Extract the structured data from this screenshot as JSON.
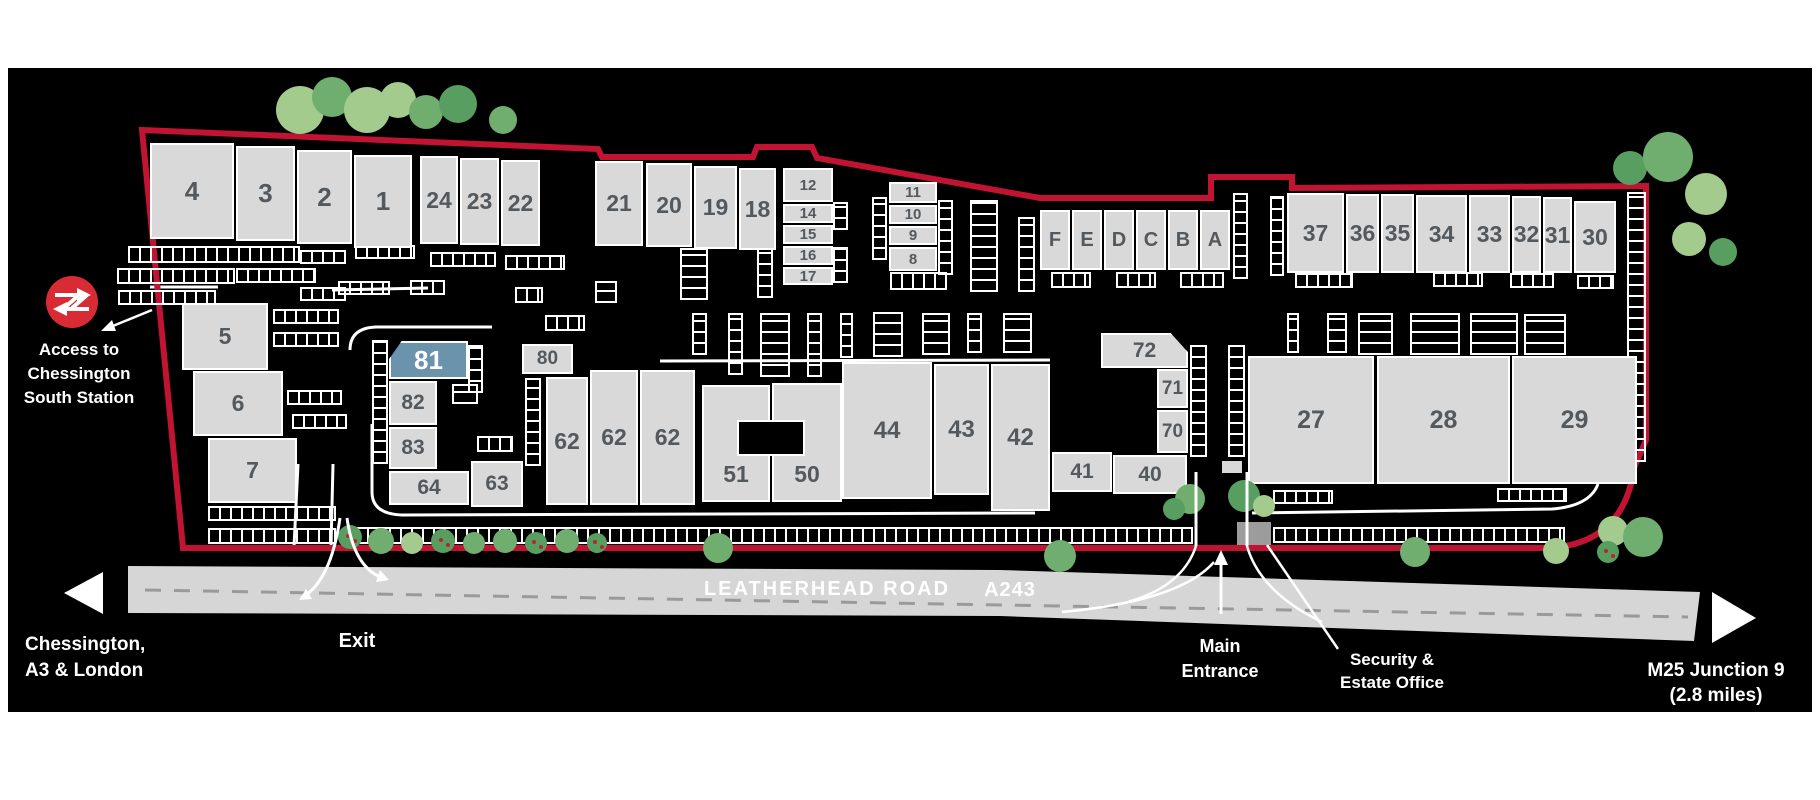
{
  "map": {
    "station_access": {
      "lines": [
        "Access to",
        "Chessington",
        "South Station"
      ]
    },
    "road": {
      "name": "LEATHERHEAD ROAD",
      "code": "A243"
    },
    "directions": {
      "west": [
        "Chessington,",
        "A3 & London"
      ],
      "east": [
        "M25 Junction 9",
        "(2.8 miles)"
      ]
    },
    "labels": {
      "exit": "Exit",
      "main_entrance": [
        "Main",
        "Entrance"
      ],
      "security_office": [
        "Security &",
        "Estate Office"
      ]
    },
    "buildings": [
      {
        "label": "4"
      },
      {
        "label": "3"
      },
      {
        "label": "2"
      },
      {
        "label": "1"
      },
      {
        "label": "24"
      },
      {
        "label": "23"
      },
      {
        "label": "22"
      },
      {
        "label": "21"
      },
      {
        "label": "20"
      },
      {
        "label": "19"
      },
      {
        "label": "18"
      },
      {
        "label": "12"
      },
      {
        "label": "14"
      },
      {
        "label": "15"
      },
      {
        "label": "16"
      },
      {
        "label": "17"
      },
      {
        "label": "11"
      },
      {
        "label": "10"
      },
      {
        "label": "9"
      },
      {
        "label": "8"
      },
      {
        "label": "F"
      },
      {
        "label": "E"
      },
      {
        "label": "D"
      },
      {
        "label": "C"
      },
      {
        "label": "B"
      },
      {
        "label": "A"
      },
      {
        "label": "37"
      },
      {
        "label": "36"
      },
      {
        "label": "35"
      },
      {
        "label": "34"
      },
      {
        "label": "33"
      },
      {
        "label": "32"
      },
      {
        "label": "31"
      },
      {
        "label": "30"
      },
      {
        "label": "5"
      },
      {
        "label": "6"
      },
      {
        "label": "7"
      },
      {
        "label": "81",
        "highlighted": true
      },
      {
        "label": "82"
      },
      {
        "label": "83"
      },
      {
        "label": "64"
      },
      {
        "label": "63"
      },
      {
        "label": "80"
      },
      {
        "label": "62"
      },
      {
        "label": "62"
      },
      {
        "label": "62"
      },
      {
        "label": "51"
      },
      {
        "label": "50"
      },
      {
        "label": "44"
      },
      {
        "label": "43"
      },
      {
        "label": "42"
      },
      {
        "label": "72"
      },
      {
        "label": "71"
      },
      {
        "label": "70"
      },
      {
        "label": "41"
      },
      {
        "label": "40"
      },
      {
        "label": "27"
      },
      {
        "label": "28"
      },
      {
        "label": "29"
      }
    ],
    "colors": {
      "boundary": "#c11332",
      "building": "#d9d9d9",
      "highlight": "#6b93ab",
      "rail_logo": "#d92b33",
      "road": "#d6d6d6",
      "tree_palette": [
        "#a4cb8e",
        "#6fae6e",
        "#579e60"
      ]
    }
  }
}
